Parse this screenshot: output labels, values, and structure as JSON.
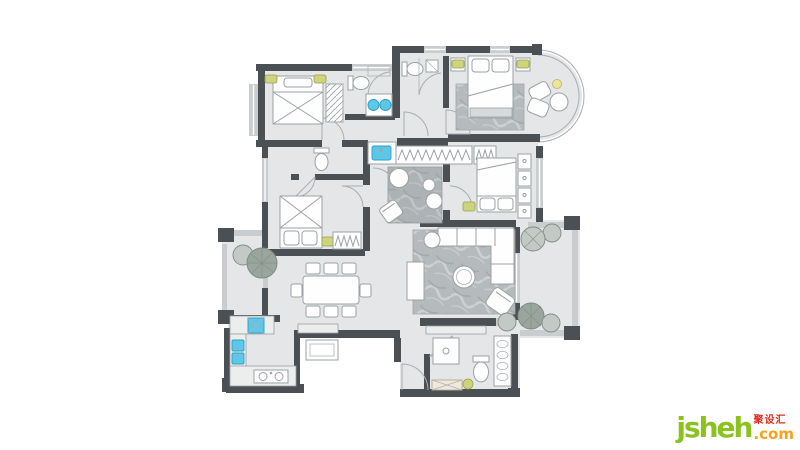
{
  "watermark": {
    "brand": "jsheh",
    "tld": ".com",
    "chinese": "聚设汇"
  },
  "colors": {
    "page_bg": "#ffffff",
    "floor": "#e4e6e7",
    "wall_dark": "#4b5054",
    "wall_light": "#c9cdcf",
    "line": "#9aa1a5",
    "furniture_fill": "#fefefe",
    "counter_fill": "#eceeee",
    "rug_base": "#b5babc",
    "rug_vein_light": "#cdd1d3",
    "rug_vein_dark": "#9da3a6",
    "fixture_blue": "#5ec7e8",
    "fixture_blue_dark": "#2e9fc6",
    "accent_green": "#cdd37f",
    "accent_green_dark": "#9aa23f",
    "lamp_yellow": "#ece59b",
    "tree_dark": "#9aa59e",
    "tree_light": "#c3cac5",
    "tree_line": "#7f8b84",
    "bench_wood": "#efe9dd",
    "logo_green": "#8cc21e",
    "logo_orange": "#f8a11c",
    "logo_red": "#dd2b1c"
  },
  "floorplan": {
    "type": "residential-apartment-furniture-plan",
    "rooms": [
      {
        "name": "bedroom-top-left",
        "furniture": [
          "double-bed",
          "nightstand",
          "nightstand",
          "hatched-wardrobe",
          "bay-window"
        ]
      },
      {
        "name": "bathroom-ensuite",
        "furniture": [
          "toilet",
          "corner-shower",
          "double-vanity-round-sinks"
        ]
      },
      {
        "name": "bathroom-center",
        "furniture": [
          "toilet",
          "shower"
        ]
      },
      {
        "name": "master-bedroom",
        "furniture": [
          "double-bed",
          "rug",
          "nightstand",
          "nightstand",
          "bed-bench",
          "lounge-chair",
          "lounge-chair",
          "round-table",
          "lamp",
          "curved-bay-window"
        ]
      },
      {
        "name": "walk-in-closet",
        "furniture": [
          "hanging-rail",
          "hanging-rail",
          "dresser-drawers"
        ]
      },
      {
        "name": "bedroom-right",
        "furniture": [
          "double-bed",
          "nightstand",
          "wardrobe-cabinets"
        ]
      },
      {
        "name": "bathroom-left",
        "furniture": [
          "toilet",
          "wash-basin-niche"
        ]
      },
      {
        "name": "bedroom-left",
        "furniture": [
          "double-bed",
          "nightstand",
          "zigzag-wardrobe"
        ]
      },
      {
        "name": "tea-room",
        "furniture": [
          "marble-rug",
          "floor-stool",
          "floor-stool",
          "floor-stool",
          "tilted-chair"
        ]
      },
      {
        "name": "dining-room",
        "furniture": [
          "dining-table",
          "chair",
          "chair",
          "chair",
          "chair",
          "chair",
          "chair",
          "chair",
          "chair"
        ]
      },
      {
        "name": "kitchen",
        "furniture": [
          "double-blue-sink",
          "two-burner-cooktop",
          "l-counter",
          "washing-machine"
        ]
      },
      {
        "name": "living-room",
        "furniture": [
          "corner-sofa",
          "round-coffee-table",
          "round-side-table",
          "tilted-armchair",
          "tv-cabinet",
          "marble-rug"
        ]
      },
      {
        "name": "balcony-left",
        "furniture": [
          "tree",
          "tree",
          "laundry-counter"
        ]
      },
      {
        "name": "balcony-right",
        "furniture": [
          "tree",
          "tree",
          "tree",
          "tree"
        ]
      },
      {
        "name": "bathroom-bottom",
        "furniture": [
          "toilet",
          "shower-tray",
          "towel-column",
          "bench",
          "plant"
        ]
      },
      {
        "name": "entry",
        "furniture": [
          "entry-door",
          "outdoor-step"
        ]
      }
    ]
  }
}
